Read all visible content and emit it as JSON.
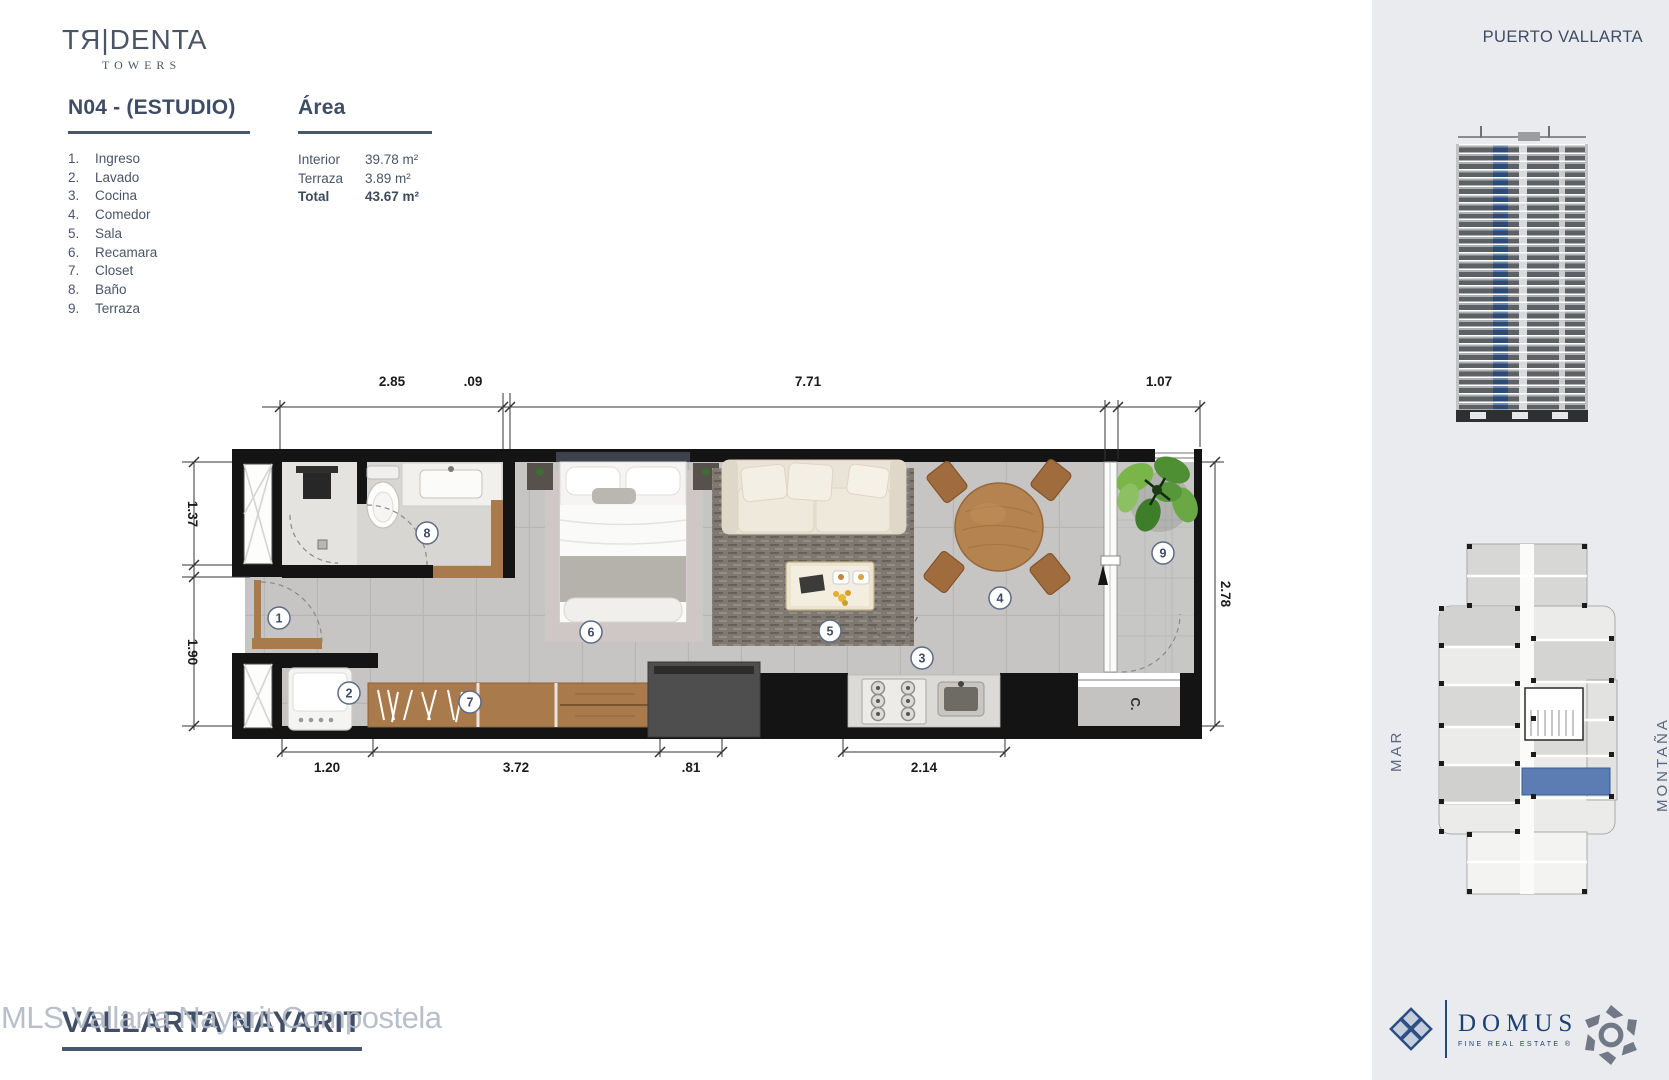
{
  "brand": {
    "name": "TЯ|DENTA",
    "sub": "TOWERS"
  },
  "sheet": {
    "unit_title": "N04 - (ESTUDIO)",
    "area_title": "Área",
    "legend": [
      {
        "n": "1.",
        "label": "Ingreso"
      },
      {
        "n": "2.",
        "label": "Lavado"
      },
      {
        "n": "3.",
        "label": "Cocina"
      },
      {
        "n": "4.",
        "label": "Comedor"
      },
      {
        "n": "5.",
        "label": "Sala"
      },
      {
        "n": "6.",
        "label": "Recamara"
      },
      {
        "n": "7.",
        "label": "Closet"
      },
      {
        "n": "8.",
        "label": "Baño"
      },
      {
        "n": "9.",
        "label": "Terraza"
      }
    ],
    "area_rows": [
      {
        "label": "Interior",
        "value": "39.78 m²"
      },
      {
        "label": "Terraza",
        "value": "3.89 m²"
      },
      {
        "label": "Total",
        "value": "43.67 m²"
      }
    ]
  },
  "plan": {
    "numbers": [
      "1",
      "2",
      "3",
      "4",
      "5",
      "6",
      "7",
      "8",
      "9"
    ],
    "closet_label": "C.",
    "dims": {
      "top": [
        "2.85",
        ".09",
        "7.71",
        "1.07"
      ],
      "left": [
        "1.37",
        "1.90"
      ],
      "right": [
        "2.78"
      ],
      "bottom": [
        "1.20",
        "3.72",
        ".81",
        "2.14"
      ]
    }
  },
  "sidebar": {
    "location": "PUERTO VALLARTA",
    "orientation_left": "MAR",
    "orientation_right": "MONTAÑA",
    "domus": {
      "name": "DOMUS",
      "tagline": "FINE REAL ESTATE",
      "registered": "®"
    }
  },
  "watermark": {
    "overlay": "MLS Vallarta Nayarit Compostela",
    "title": "VALLARTA NAYARIT"
  },
  "colors": {
    "heading": "#3f4c66",
    "sidebar_bg": "#e9ebee",
    "unit_highlight": "#5b7db3",
    "domus_blue": "#1d3f72",
    "wall_black": "#141414"
  }
}
